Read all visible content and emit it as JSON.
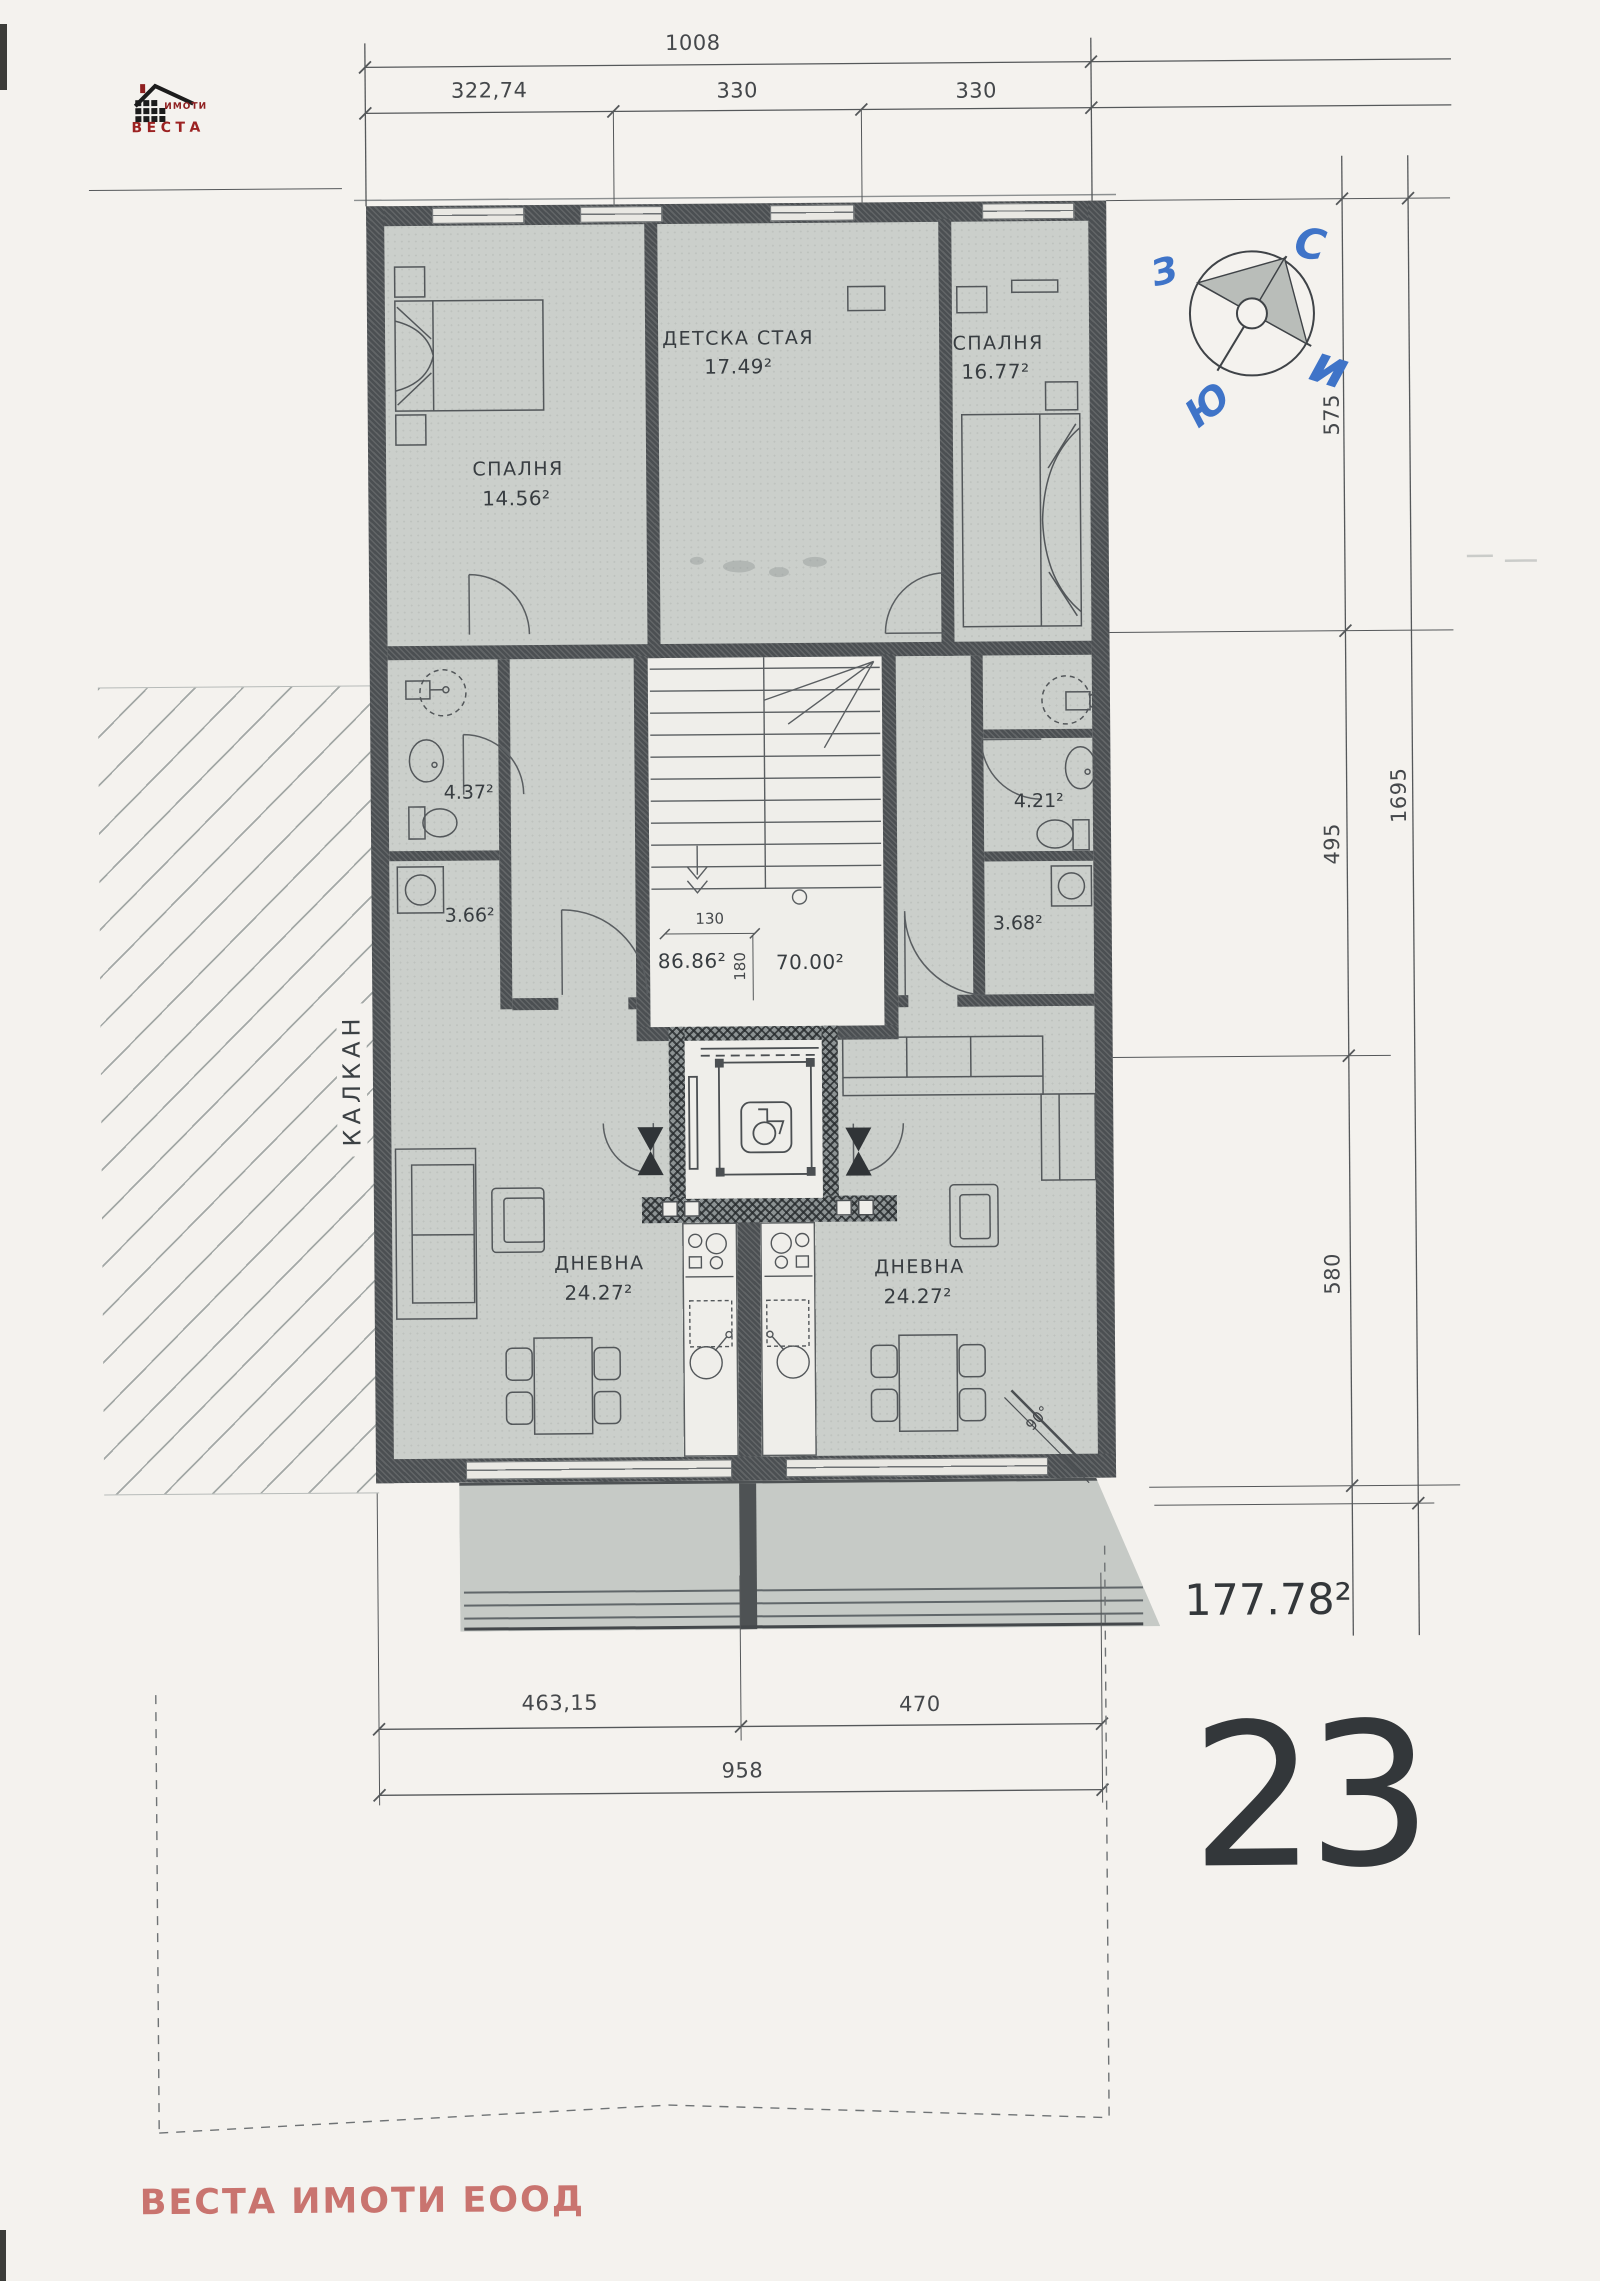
{
  "logo": {
    "imoti": "ИМОТИ",
    "vesta": "ВЕСТА"
  },
  "compass": {
    "west": "З",
    "north": "С",
    "east": "и",
    "south": "Ю"
  },
  "dims": {
    "top_total": "1008",
    "top_seg1": "322,74",
    "top_seg2": "330",
    "top_seg3": "330",
    "right_seg1": "575",
    "right_seg2": "495",
    "right_seg3": "580",
    "right_total": "1695",
    "stair_width": "130",
    "stair_depth": "180",
    "bottom_seg1": "463,15",
    "bottom_seg2": "470",
    "bottom_total": "958",
    "corner_angle": "90°"
  },
  "rooms": {
    "bedroom_left": {
      "name": "СПАЛНЯ",
      "area": "14.56²"
    },
    "kids_room": {
      "name": "ДЕТСКА СТАЯ",
      "area": "17.49²"
    },
    "bedroom_right": {
      "name": "СПАЛНЯ",
      "area": "16.77²"
    },
    "bath_left": {
      "area": "4.37²"
    },
    "storage_left": {
      "area": "3.66²"
    },
    "bath_right": {
      "area": "4.21²"
    },
    "storage_right": {
      "area": "3.68²"
    },
    "common_area_left": {
      "area": "86.86²"
    },
    "common_area_right": {
      "area": "70.00²"
    },
    "living_left": {
      "name": "ДНЕВНА",
      "area": "24.27²"
    },
    "living_right": {
      "name": "ДНЕВНА",
      "area": "24.27²"
    }
  },
  "annotations": {
    "side_wall": "КАЛКАН"
  },
  "summary": {
    "total_area": "177.78²",
    "unit_number": "23"
  },
  "footer": {
    "company": "ВЕСТА ИМОТИ ЕООД"
  }
}
